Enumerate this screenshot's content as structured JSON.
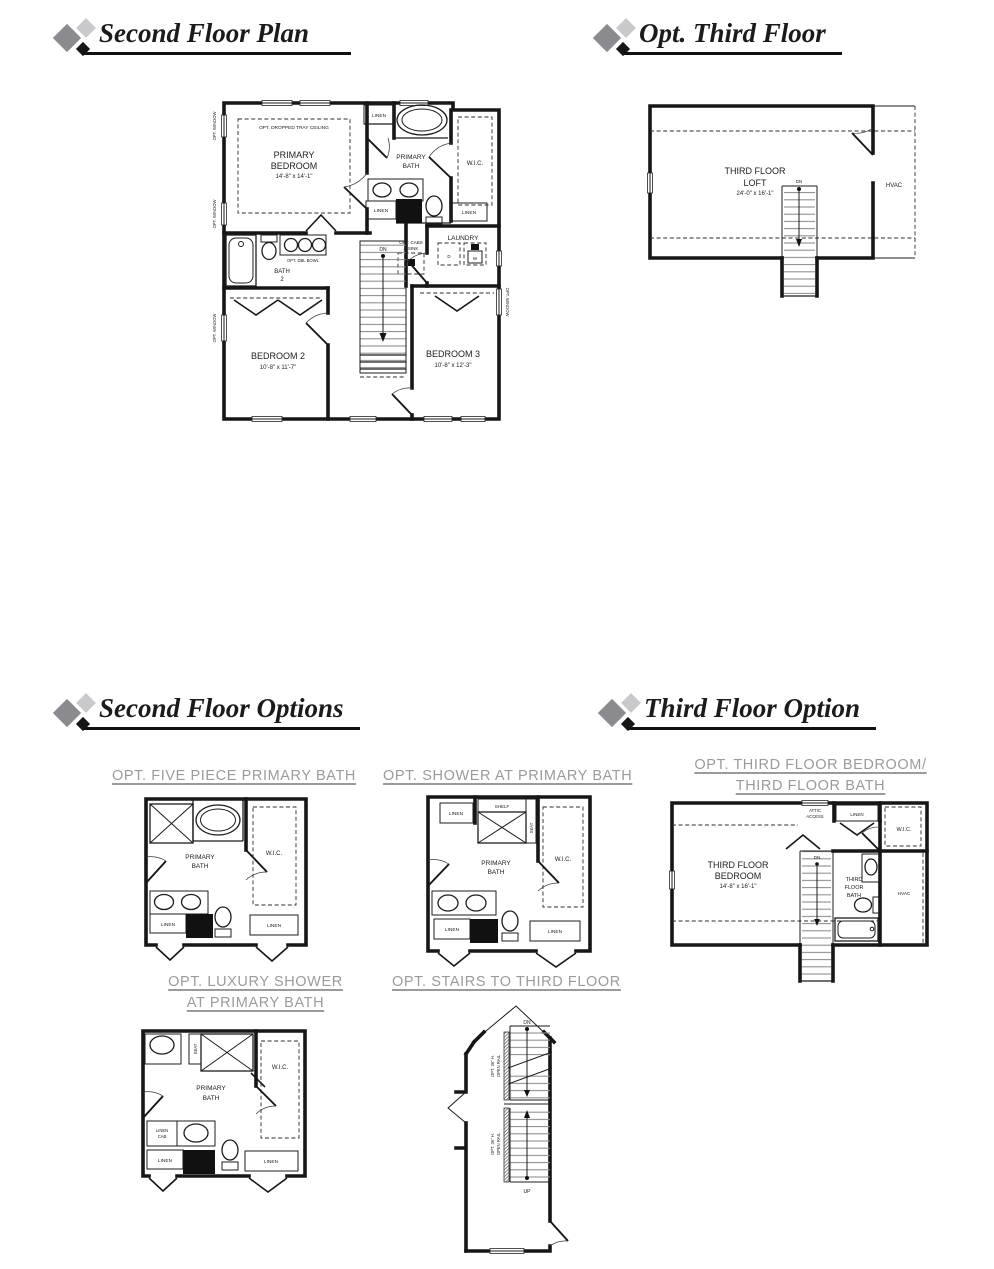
{
  "colors": {
    "logo_gray": "#8b8b8f",
    "logo_light_gray": "#c9c9cb",
    "logo_black": "#161616",
    "header_text": "#1b1b1b",
    "option_title_gray": "#9b9b9b",
    "plan_line": "#161616",
    "stair_tread_gray": "#8f8f8f"
  },
  "headers": {
    "second_floor_plan": "Second Floor Plan",
    "opt_third_floor": "Opt. Third Floor",
    "second_floor_options": "Second Floor Options",
    "third_floor_option": "Third Floor Option"
  },
  "option_titles": {
    "five_piece": "OPT. FIVE PIECE PRIMARY BATH",
    "shower": "OPT. SHOWER AT PRIMARY BATH",
    "third_bedroom_line1": "OPT. THIRD FLOOR BEDROOM/",
    "third_bedroom_line2": "THIRD FLOOR BATH",
    "luxury_line1": "OPT. LUXURY SHOWER",
    "luxury_line2": "AT PRIMARY BATH",
    "stairs": "OPT. STAIRS TO THIRD FLOOR"
  },
  "second_floor": {
    "opt_window": "OPT. WINDOW",
    "tray_ceiling": "OPT. DROPPED TRAY CEILING",
    "primary_bedroom": {
      "l1": "PRIMARY",
      "l2": "BEDROOM",
      "dims": "14'-8\" x 14'-1\""
    },
    "primary_bath": {
      "l1": "PRIMARY",
      "l2": "BATH"
    },
    "wic": "W.I.C.",
    "linen": "LINEN",
    "opt_dbl_bowl": "OPT. DBL BOWL",
    "bath2": {
      "l1": "BATH",
      "l2": "2"
    },
    "laundry": "LAUNDRY",
    "dryer": "D",
    "washer": "W",
    "opt_cabs": {
      "l1": "OPT. CABS",
      "l2": "& SINK"
    },
    "dn": "DN",
    "bedroom2": {
      "name": "BEDROOM 2",
      "dims": "10'-8\" x 11'-7\""
    },
    "bedroom3": {
      "name": "BEDROOM 3",
      "dims": "10'-8\" x 12'-3\""
    }
  },
  "third_floor": {
    "loft": {
      "l1": "THIRD FLOOR",
      "l2": "LOFT",
      "dims": "24'-0\" x 16'-1\""
    },
    "hvac": "HVAC",
    "dn": "DN"
  },
  "opt_five_piece": {
    "primary_bath": {
      "l1": "PRIMARY",
      "l2": "BATH"
    },
    "wic": "W.I.C.",
    "linen": "LINEN"
  },
  "opt_shower": {
    "linen": "LINEN",
    "shelf": "SHELF",
    "seat": "SEAT",
    "primary_bath": {
      "l1": "PRIMARY",
      "l2": "BATH"
    },
    "wic": "W.I.C."
  },
  "opt_third_bedroom": {
    "attic": {
      "l1": "ATTIC",
      "l2": "ACCESS"
    },
    "linen": "LINEN",
    "wic": "W.I.C.",
    "bedroom": {
      "l1": "THIRD FLOOR",
      "l2": "BEDROOM",
      "dims": "14'-8\" x 16'-1\""
    },
    "dn": "DN",
    "bath": {
      "l1": "THIRD",
      "l2": "FLOOR",
      "l3": "BATH"
    },
    "hvac": "HVAC"
  },
  "opt_luxury": {
    "seat": "SEAT",
    "primary_bath": {
      "l1": "PRIMARY",
      "l2": "BATH"
    },
    "wic": "W.I.C.",
    "linen_cab": {
      "l1": "LINEN",
      "l2": "CAB"
    },
    "linen": "LINEN"
  },
  "opt_stairs": {
    "dn": "DN",
    "up": "UP",
    "rail": {
      "l1": "OPT. 36\" H.",
      "l2": "OPEN RAIL"
    }
  }
}
